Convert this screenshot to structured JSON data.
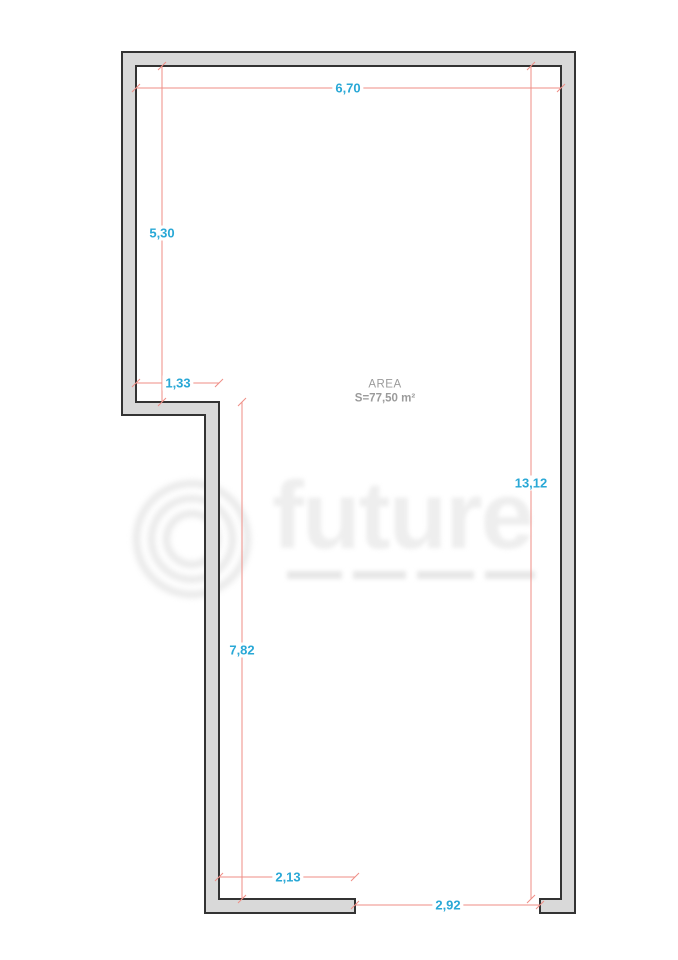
{
  "plan": {
    "area": {
      "label": "AREA",
      "value": "S=77,50 m²"
    },
    "dimensions": {
      "top_width": "6,70",
      "upper_left_height": "5,30",
      "step_width": "1,33",
      "right_height": "13,12",
      "lower_left_height": "7,82",
      "bottom_left_width": "2,13",
      "bottom_opening_width": "2,92"
    },
    "colors": {
      "wall_fill": "#d9d9d9",
      "wall_stroke": "#333333",
      "dimension_line": "#ef8e86",
      "dimension_text": "#29a8d6",
      "area_text": "#9b9b9b",
      "watermark": "#eeeeee"
    }
  },
  "watermark": {
    "brand": "future"
  }
}
